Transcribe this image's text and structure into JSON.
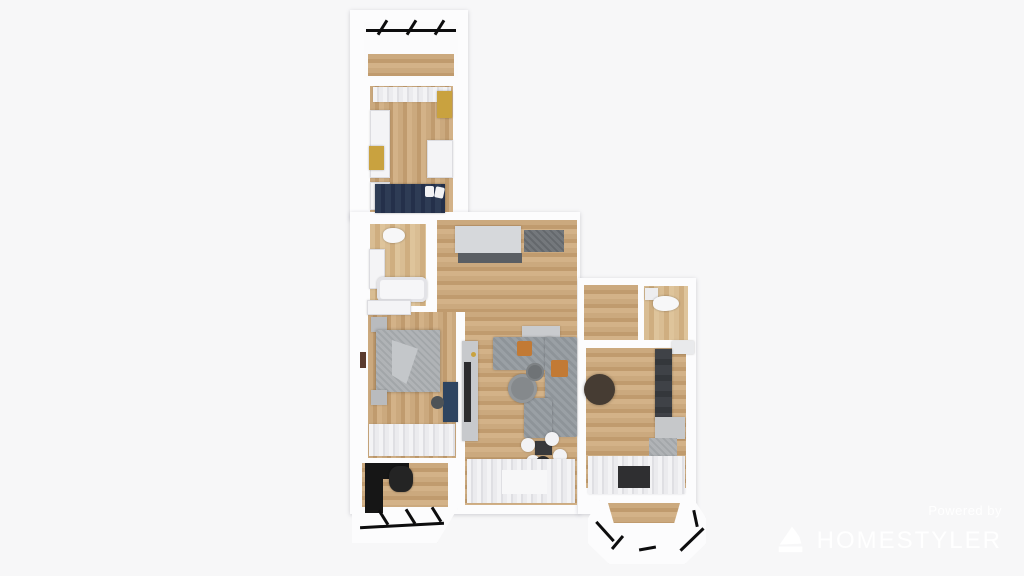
{
  "watermark": {
    "powered_by_label": "Powered by",
    "brand_name": "HOMESTYLER",
    "logo_icon": "homestyler-logo-icon"
  },
  "palette": {
    "background": "#f7f7f8",
    "wall_white": "#fcfcfd",
    "floor_wood": "#c8a377",
    "floor_wood_light": "#d9bd93",
    "window_frame_black": "#0d0d0e",
    "bed_navy": "#2e3c55",
    "desk_navy": "#2e4460",
    "cabinet_gold": "#c9a23f",
    "cushion_orange": "#c27a35",
    "sofa_gray": "#9aa0a5",
    "counter_dark": "#3f4247",
    "furniture_black": "#161616",
    "curtain_white": "#f3f3f5",
    "watermark_white": "#fdfdfe"
  },
  "floorplan": {
    "view": "top-down 3D render of apartment",
    "rooms": [
      {
        "id": "balcony-top",
        "features": [
          "black-frame-window-wall",
          "wood-floor"
        ]
      },
      {
        "id": "bedroom-top",
        "features": [
          "curtains",
          "white-wardrobe",
          "gold-cabinets",
          "white-desk",
          "navy-bed-with-pillows"
        ]
      },
      {
        "id": "bathroom",
        "features": [
          "toilet",
          "vanity-sink",
          "bathtub"
        ]
      },
      {
        "id": "hallway",
        "features": [
          "gray-wardrobe",
          "dark-counter",
          "doormat",
          "sideboard"
        ]
      },
      {
        "id": "wc",
        "features": [
          "toilet",
          "cistern"
        ]
      },
      {
        "id": "bedroom-left",
        "features": [
          "gray-bed",
          "nightstands",
          "white-wardrobe",
          "navy-desk",
          "desk-chair",
          "wall-art",
          "window-rug"
        ]
      },
      {
        "id": "living-room",
        "features": [
          "tv-unit",
          "sectional-sofa",
          "orange-cushions",
          "round-coffee-tables",
          "dining-table-with-chairs",
          "round-rug",
          "window-curtains"
        ]
      },
      {
        "id": "kitchen",
        "features": [
          "round-dining-table",
          "dark-counter-run",
          "appliances",
          "fridge",
          "floor-mat",
          "window-curtains"
        ]
      },
      {
        "id": "loggia-office",
        "features": [
          "black-desk",
          "office-chair",
          "black-frame-window-wall"
        ]
      },
      {
        "id": "bay-balcony",
        "features": [
          "octagonal-bay-window",
          "black-frame-glazing",
          "wood-floor"
        ]
      }
    ]
  }
}
